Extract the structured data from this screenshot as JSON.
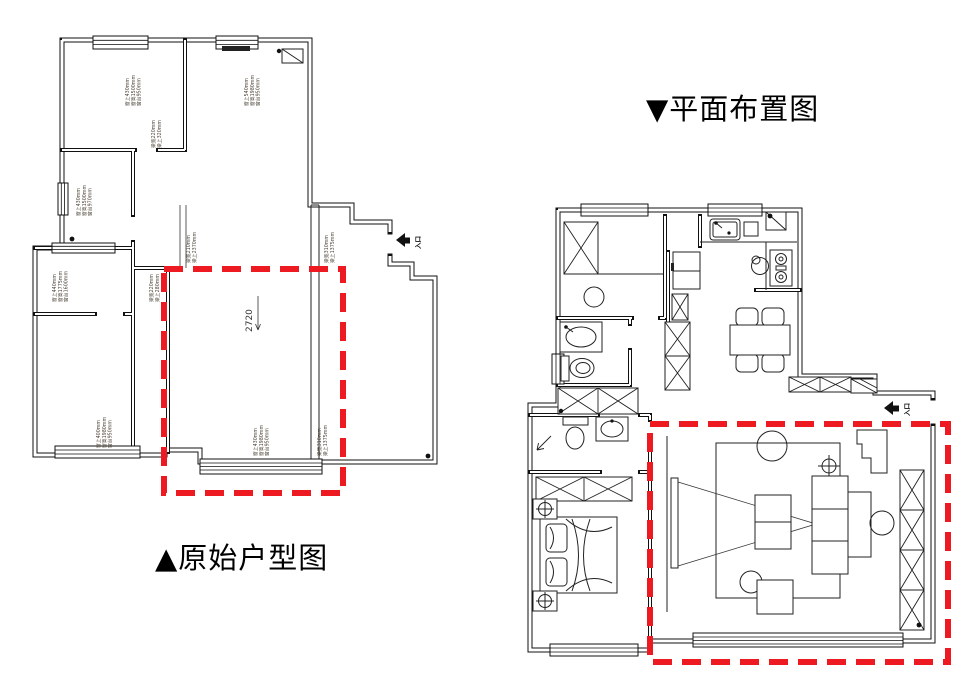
{
  "colors": {
    "highlight_red": "#ee1a22",
    "wall": "#111111"
  },
  "titles": {
    "original_plan": "▲原始户型图",
    "layout_plan": "▼平面布置图"
  },
  "original_plan": {
    "dimension_label": "2720",
    "entry_label": "入口",
    "measurement_labels": [
      {
        "id": "bedroom1-window",
        "x": 129,
        "y": 106,
        "lines": [
          "窗上430mm",
          "窗高1500mm",
          "窗台950mm"
        ]
      },
      {
        "id": "bedroom1-beam",
        "x": 155,
        "y": 148,
        "lines": [
          "梁宽220mm",
          "梁上320mm"
        ]
      },
      {
        "id": "living-top-window",
        "x": 248,
        "y": 106,
        "lines": [
          "窗上540mm",
          "窗高1980mm",
          "窗台950mm"
        ]
      },
      {
        "id": "room2-window",
        "x": 80,
        "y": 216,
        "lines": [
          "窗上430mm",
          "窗高1500mm",
          "窗台970mm"
        ]
      },
      {
        "id": "room3-window",
        "x": 56,
        "y": 302,
        "lines": [
          "窗上440mm",
          "窗高1775mm",
          "窗台1600mm"
        ]
      },
      {
        "id": "room4-window",
        "x": 100,
        "y": 448,
        "lines": [
          "窗上400mm",
          "窗高1980mm",
          "窗台950mm"
        ]
      },
      {
        "id": "center-beam",
        "x": 190,
        "y": 263,
        "lines": [
          "梁宽210mm",
          "梁上2370mm"
        ]
      },
      {
        "id": "right-beam-top",
        "x": 328,
        "y": 263,
        "lines": [
          "梁宽310mm",
          "梁上1375mm"
        ]
      },
      {
        "id": "redbox-beam",
        "x": 153,
        "y": 302,
        "lines": [
          "梁宽220mm",
          "梁上280mm"
        ]
      },
      {
        "id": "bottom-window",
        "x": 257,
        "y": 456,
        "lines": [
          "窗上430mm",
          "窗高1980mm",
          "窗台950mm"
        ]
      },
      {
        "id": "right-beam-bottom",
        "x": 321,
        "y": 456,
        "lines": [
          "梁宽310mm",
          "梁上1375mm"
        ]
      }
    ]
  },
  "layout_plan": {
    "entry_label": "入口"
  }
}
